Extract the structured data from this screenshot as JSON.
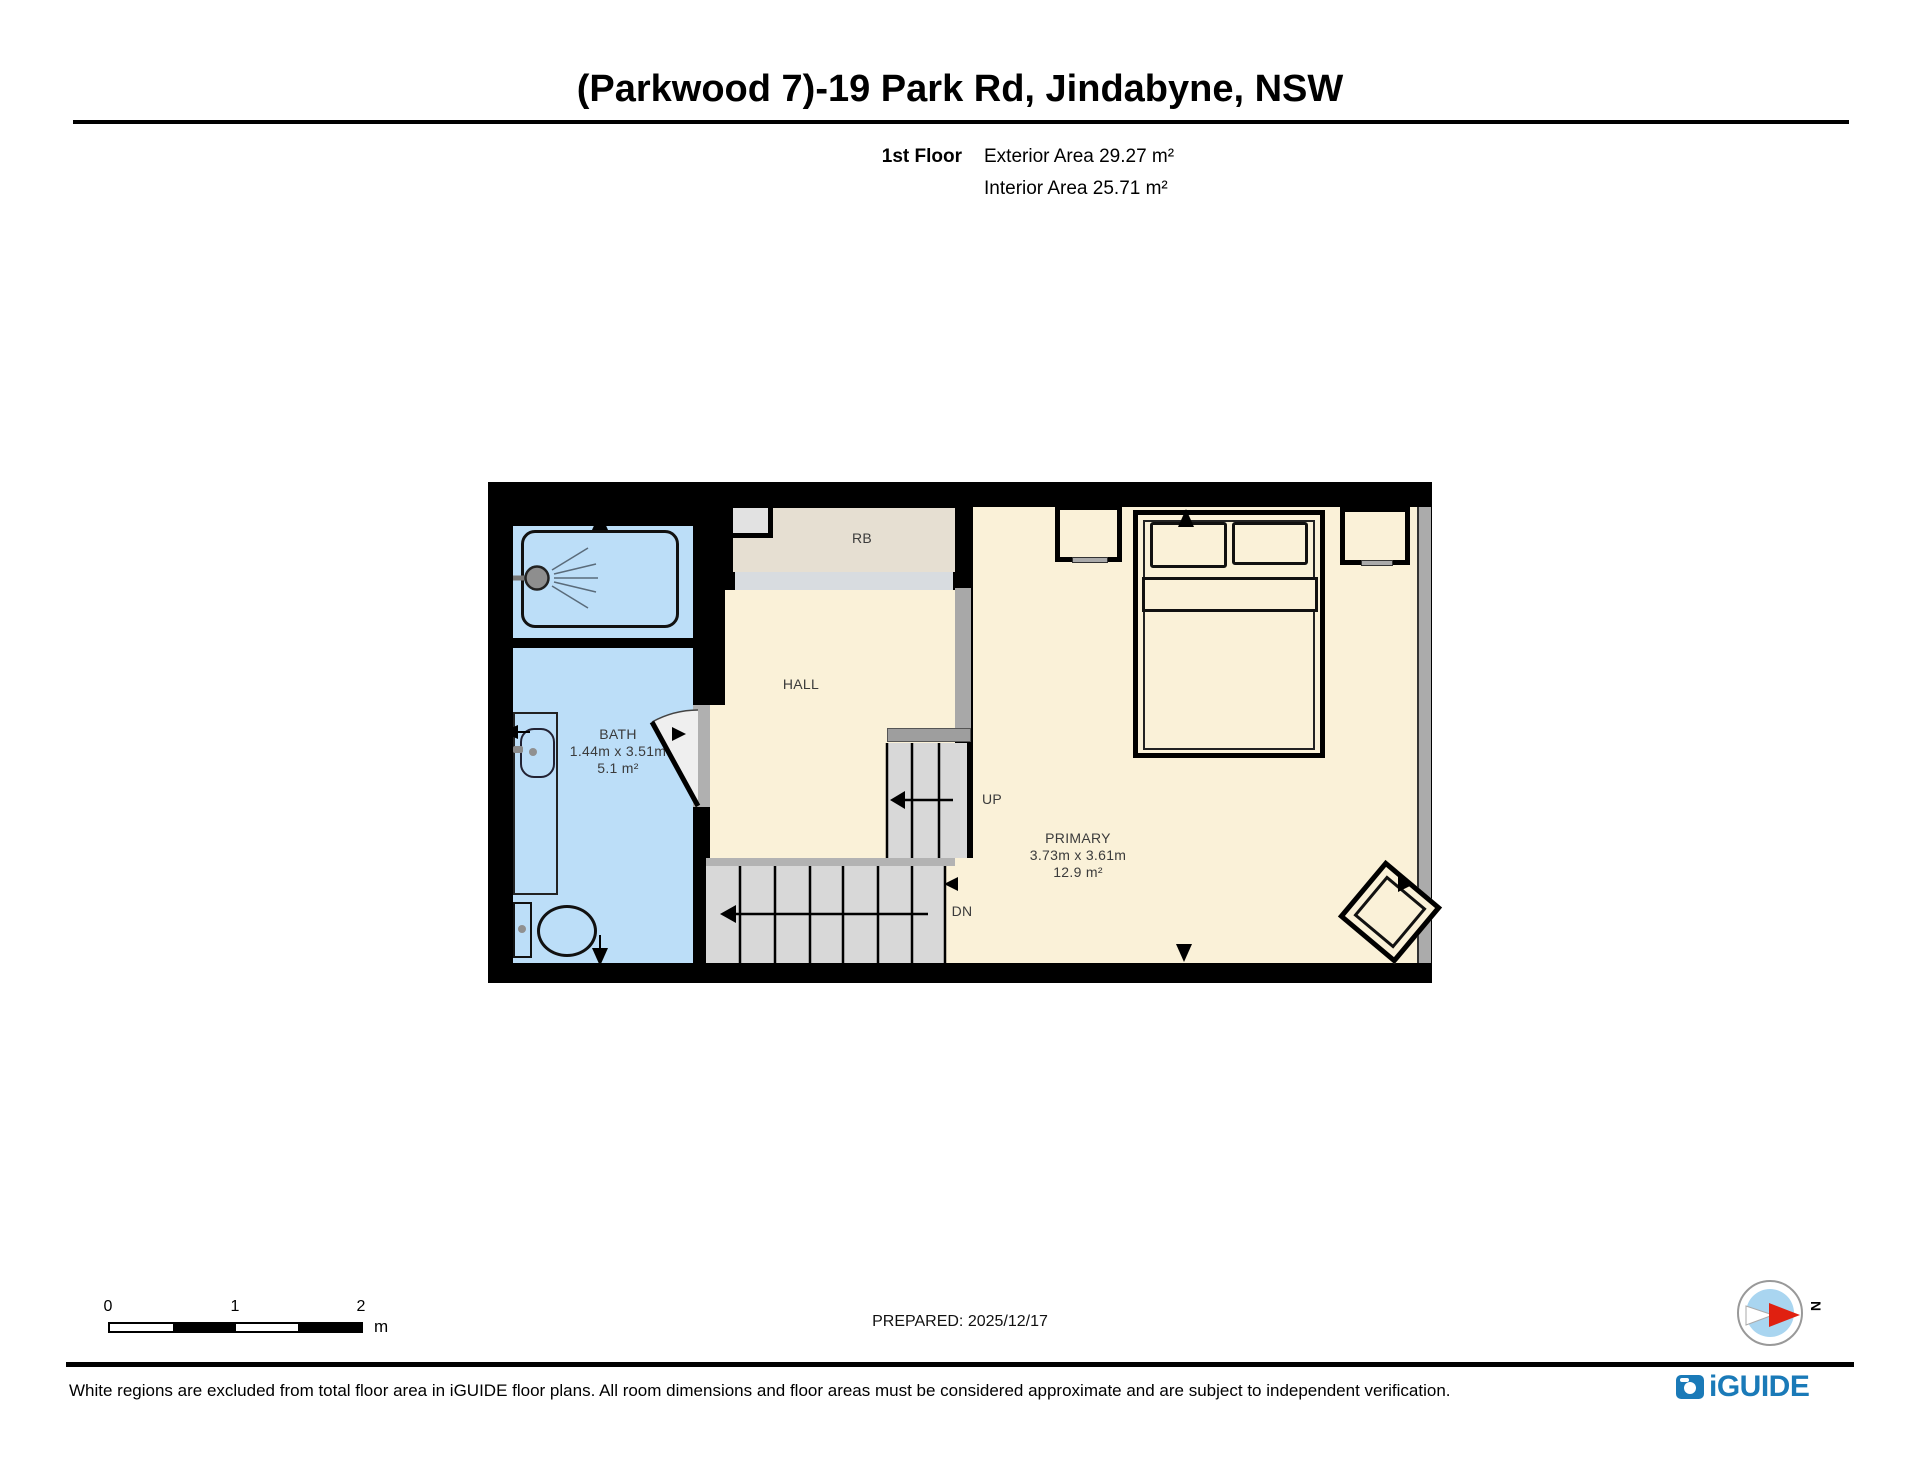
{
  "header": {
    "title": "(Parkwood 7)-19 Park Rd, Jindabyne, NSW",
    "floor_label": "1st Floor",
    "exterior_area": "Exterior Area 29.27 m²",
    "interior_area": "Interior Area 25.71 m²"
  },
  "plan": {
    "rooms": {
      "bath": {
        "name": "BATH",
        "dims": "1.44m x 3.51m",
        "area": "5.1 m²"
      },
      "hall": {
        "name": "HALL"
      },
      "robe": {
        "name": "RB"
      },
      "primary": {
        "name": "PRIMARY",
        "dims": "3.73m x 3.61m",
        "area": "12.9 m²"
      }
    },
    "stairs": {
      "up": "UP",
      "down": "DN"
    }
  },
  "scalebar": {
    "t0": "0",
    "t1": "1",
    "t2": "2",
    "unit": "m"
  },
  "footer": {
    "prepared": "PREPARED: 2025/12/17",
    "disclaimer": "White regions are excluded from total floor area in iGUIDE floor plans. All room dimensions and floor areas must be considered approximate and are subject to independent verification.",
    "brand": "iGUIDE",
    "north": "N"
  },
  "colors": {
    "wall_black": "#000000",
    "floor_cream": "#FAF1D8",
    "wet_room_blue": "#BCDEF8",
    "closet_beige": "#E6DFD2",
    "stair_grey": "#D8D8D8",
    "opening_grey": "#A8A8A8",
    "window_grey": "#ABABAB",
    "brand_blue": "#1A7AB8",
    "compass_red": "#E02010"
  }
}
